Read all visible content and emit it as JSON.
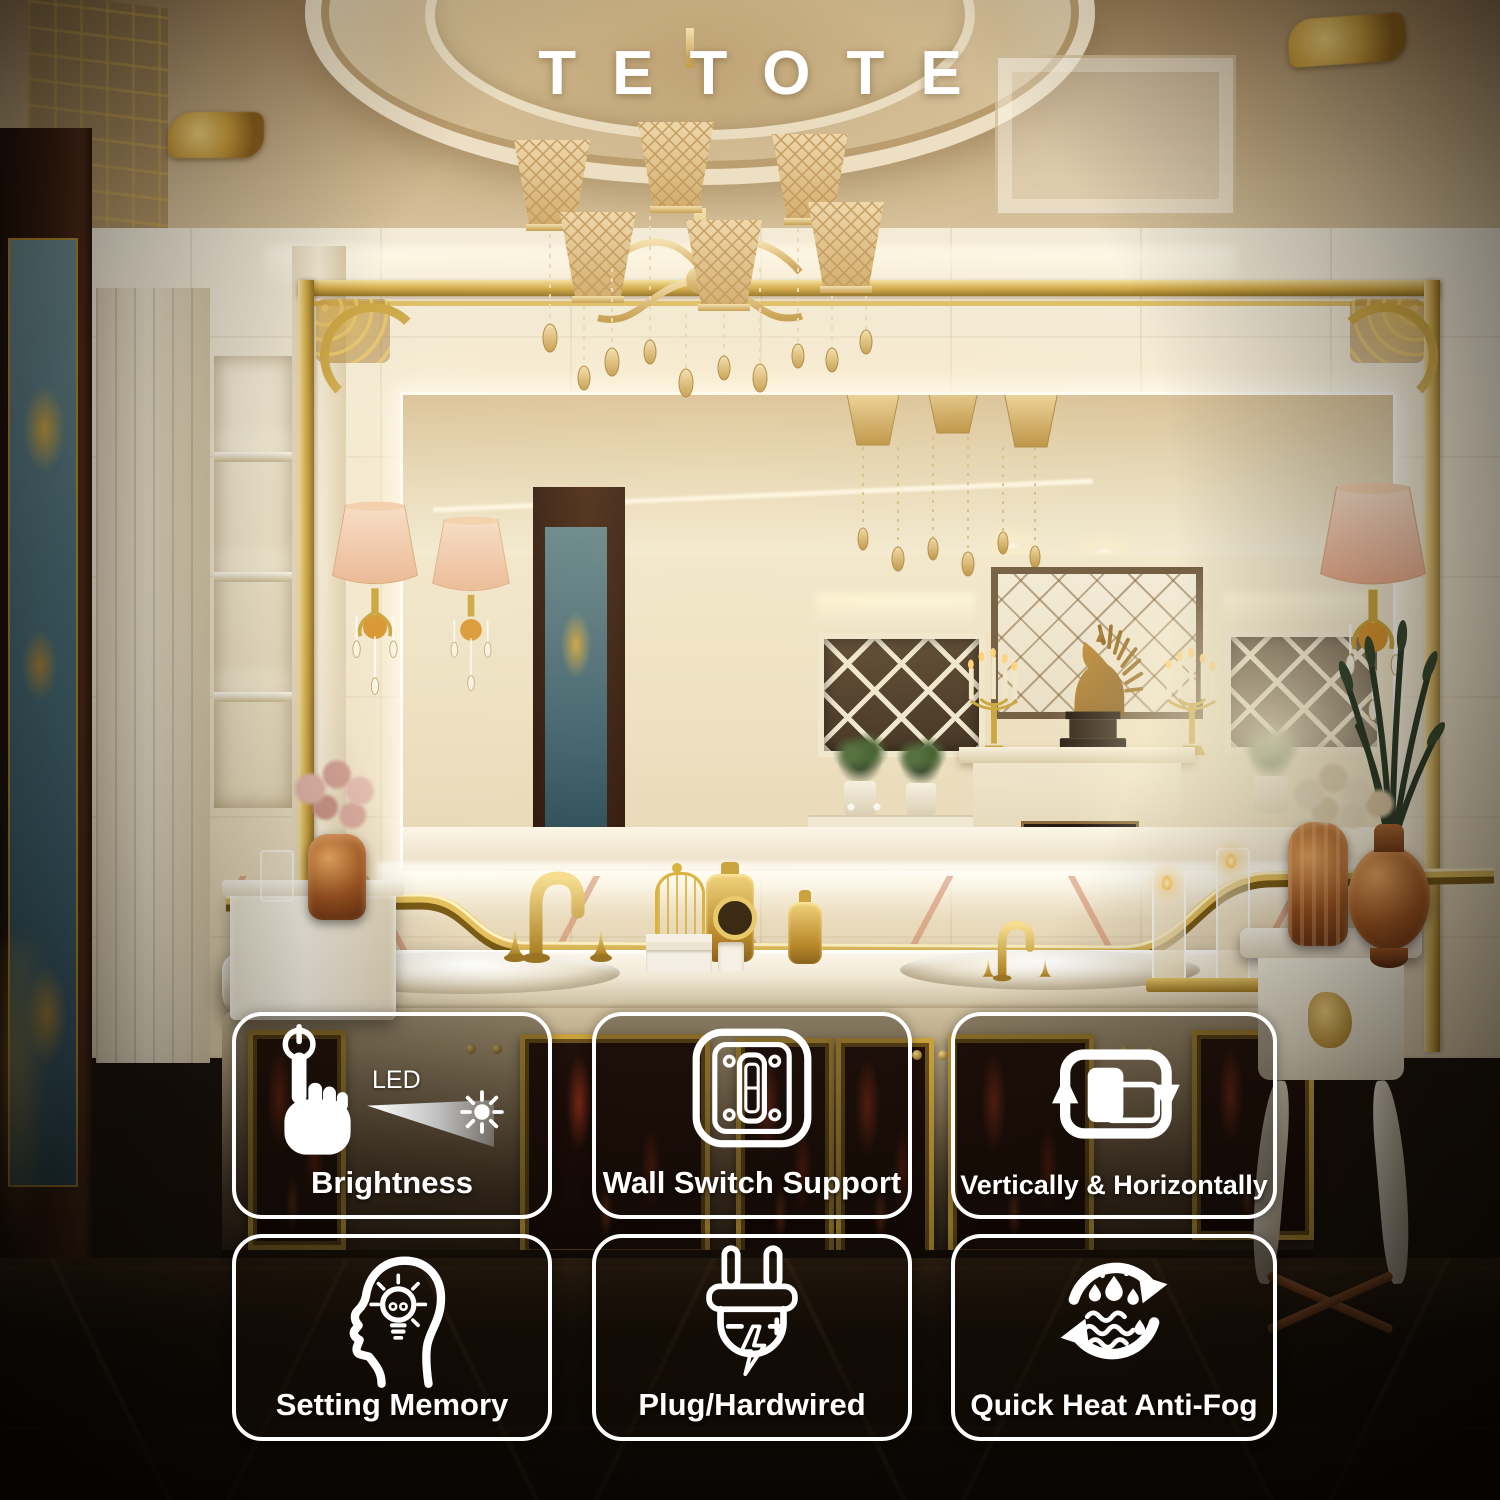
{
  "brand": {
    "logo": "TETOTE"
  },
  "features": [
    {
      "label": "Brightness",
      "icon": "touch-dimmer-icon",
      "sublabel": "LED"
    },
    {
      "label": "Wall Switch Support",
      "icon": "wall-switch-icon"
    },
    {
      "label": "Vertically & Horizontally",
      "icon": "rotate-mirror-icon"
    },
    {
      "label": "Setting Memory",
      "icon": "memory-head-icon"
    },
    {
      "label": "Plug/Hardwired",
      "icon": "power-plug-icon"
    },
    {
      "label": "Quick Heat Anti-Fog",
      "icon": "anti-fog-icon"
    }
  ],
  "colors": {
    "accent_gold": "#c9a23c",
    "led_glow": "#fff8ec",
    "badge_border": "#ffffff",
    "marble": "#efe6d2",
    "floor_dark": "#1a120a"
  }
}
